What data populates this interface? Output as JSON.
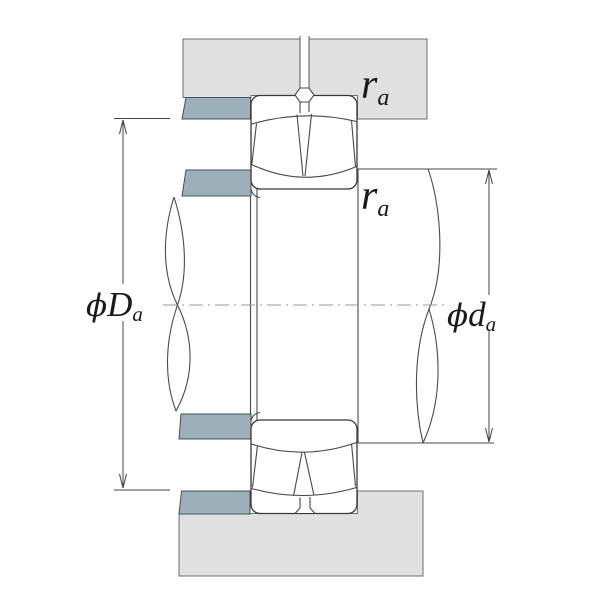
{
  "figure": {
    "type": "bearing-mounting-cross-section",
    "description": "Spherical roller bearing shaft and housing abutment dimensions",
    "labels": {
      "housing_fillet": {
        "main": "r",
        "sub": "a"
      },
      "shaft_fillet": {
        "main": "r",
        "sub": "a"
      },
      "housing_shoulder_dia": {
        "prefix": "ϕ",
        "main": "D",
        "sub": "a"
      },
      "shaft_shoulder_dia": {
        "prefix": "ϕ",
        "main": "d",
        "sub": "a"
      }
    },
    "colors": {
      "background": "#ffffff",
      "housing_fill": "#e1e1e2",
      "shoulder_fill": "#9db0ba",
      "line": "#3d3d3d",
      "centerline": "#999999",
      "label_color": "#1a1a1a"
    }
  }
}
